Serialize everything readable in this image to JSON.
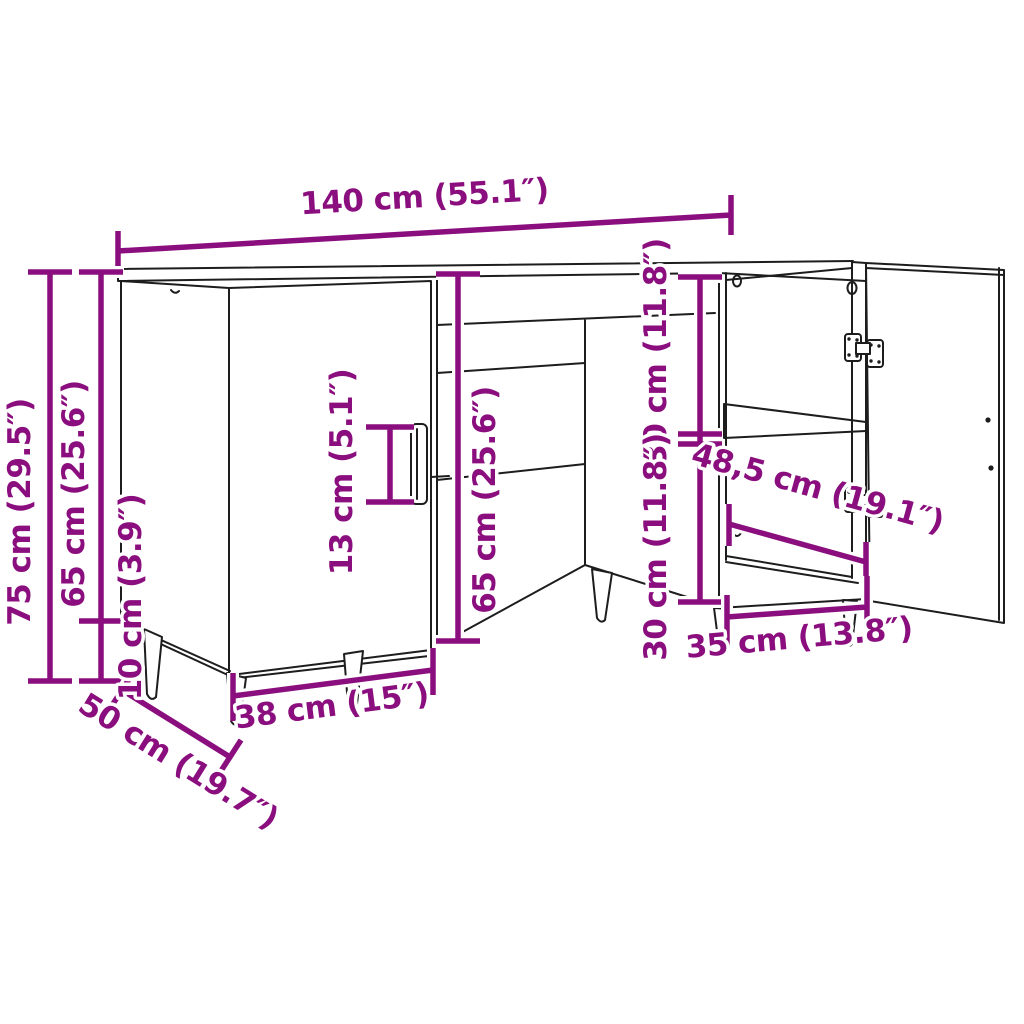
{
  "diagram": {
    "type": "furniture-dimension-diagram",
    "subject": "desk with left door cabinet, center drawer niche and right open-door cabinet",
    "colors": {
      "dimension": "#8B0E7E",
      "outline": "#1d1d1d",
      "background": "#ffffff"
    },
    "labels": {
      "width_top": "140 cm (55.1″)",
      "height_total": "75 cm (29.5″)",
      "height_body_left": "65 cm (25.6″)",
      "leg_height": "10 cm (3.9″)",
      "handle_height": "13 cm (5.1″)",
      "height_body_mid": "65 cm (25.6″)",
      "compartment_top": "30 cm (11.8″)",
      "compartment_bottom": "30 cm (11.8″)",
      "inner_depth": "48,5 cm (19.1″)",
      "inner_width": "35 cm (13.8″)",
      "door_width": "38 cm (15″)",
      "depth": "50 cm (19.7″)"
    }
  }
}
